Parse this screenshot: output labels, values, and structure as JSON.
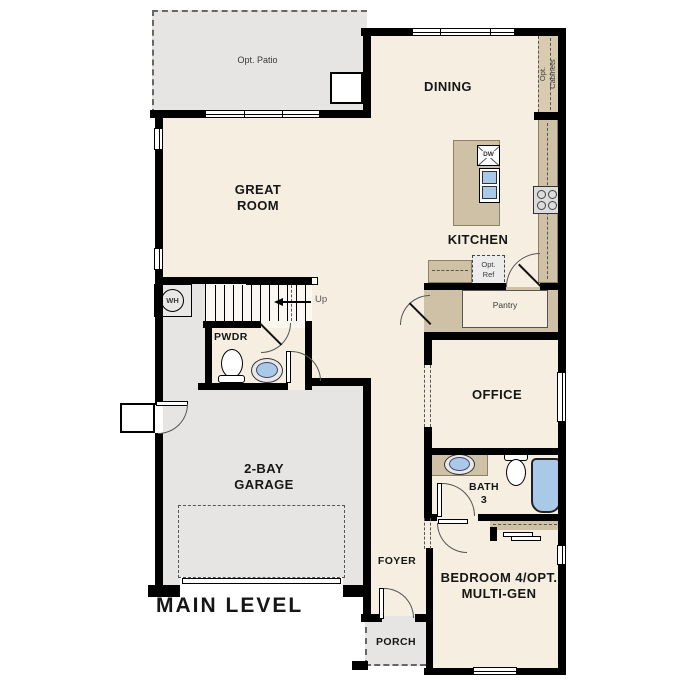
{
  "plan": {
    "level_title": "MAIN LEVEL",
    "rooms": {
      "great_room": [
        "GREAT",
        "ROOM"
      ],
      "dining": "DINING",
      "kitchen": "KITCHEN",
      "office": "OFFICE",
      "pwdr": "PWDR",
      "bath3": [
        "BATH",
        "3"
      ],
      "garage": [
        "2-BAY",
        "GARAGE"
      ],
      "foyer": "FOYER",
      "porch": "PORCH",
      "bedroom4": [
        "BEDROOM 4/OPT.",
        "MULTI-GEN"
      ],
      "pantry": "Pantry"
    },
    "optional_features": {
      "patio": "Opt. Patio",
      "cabinets": [
        "Opt.",
        "Cabinets"
      ],
      "ref": [
        "Opt.",
        "Ref"
      ]
    },
    "fixtures": {
      "dishwasher": "DW",
      "water_heater": "WH",
      "stairs_direction": "Up"
    },
    "colors": {
      "wall": "#000000",
      "interior_floor": "#f6eee0",
      "garage_floor": "#e6e5e3",
      "cabinetry": "#cfc1a6",
      "plumbing_blue": "#a9c9e9"
    }
  }
}
